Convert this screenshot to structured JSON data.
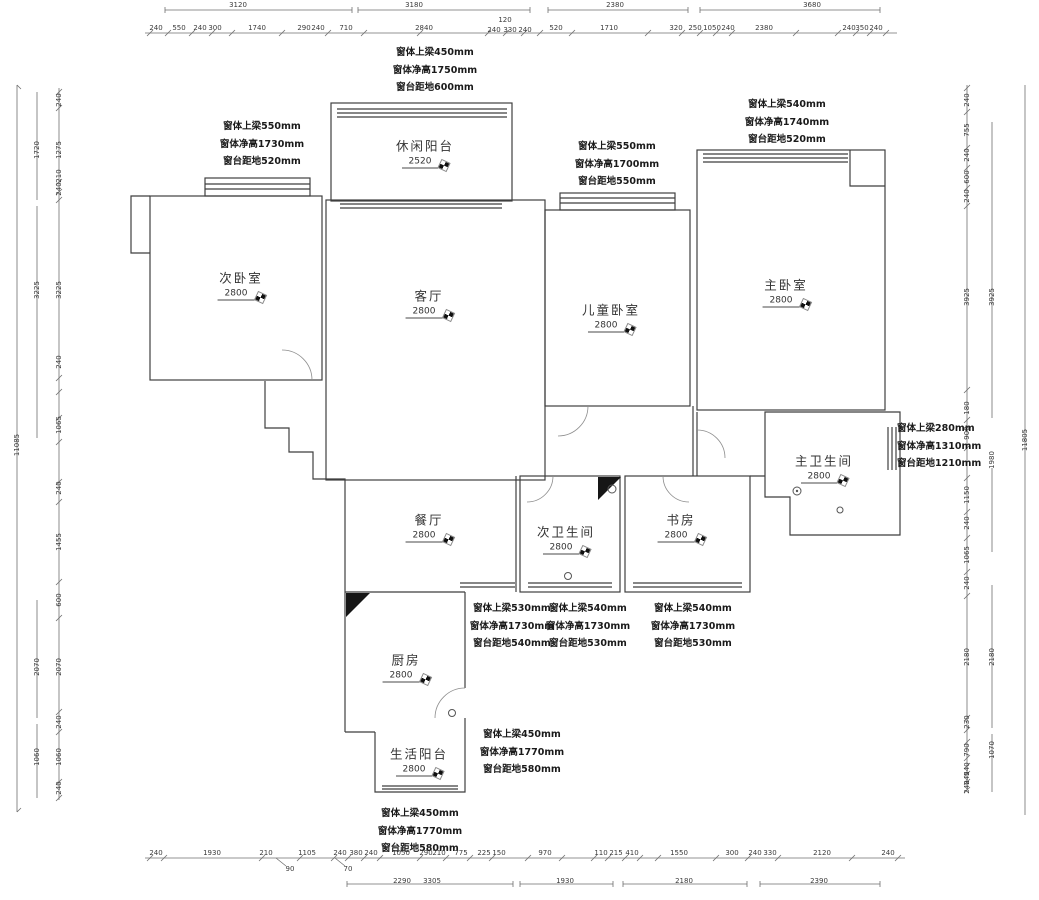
{
  "drawing": {
    "type": "residential floor plan with dimensions",
    "unit": "mm"
  },
  "rooms": [
    {
      "label": "休闲阳台",
      "value": "2520",
      "x": 425,
      "y": 152
    },
    {
      "label": "次卧室",
      "value": "2800",
      "x": 241,
      "y": 284
    },
    {
      "label": "客厅",
      "value": "2800",
      "x": 429,
      "y": 302
    },
    {
      "label": "儿童卧室",
      "value": "2800",
      "x": 611,
      "y": 316
    },
    {
      "label": "主卧室",
      "value": "2800",
      "x": 786,
      "y": 291
    },
    {
      "label": "主卫生间",
      "value": "2800",
      "x": 824,
      "y": 467
    },
    {
      "label": "餐厅",
      "value": "2800",
      "x": 429,
      "y": 526
    },
    {
      "label": "次卫生间",
      "value": "2800",
      "x": 566,
      "y": 538
    },
    {
      "label": "书房",
      "value": "2800",
      "x": 681,
      "y": 526
    },
    {
      "label": "厨房",
      "value": "2800",
      "x": 406,
      "y": 666
    },
    {
      "label": "生活阳台",
      "value": "2800",
      "x": 419,
      "y": 760
    }
  ],
  "notes": [
    {
      "x": 435,
      "y": 44,
      "lines": [
        "窗体上梁450mm",
        "窗体净高1750mm",
        "窗台距地600mm"
      ]
    },
    {
      "x": 262,
      "y": 118,
      "lines": [
        "窗体上梁550mm",
        "窗体净高1730mm",
        "窗台距地520mm"
      ]
    },
    {
      "x": 787,
      "y": 96,
      "lines": [
        "窗体上梁540mm",
        "窗体净高1740mm",
        "窗台距地520mm"
      ]
    },
    {
      "x": 617,
      "y": 138,
      "lines": [
        "窗体上梁550mm",
        "窗体净高1700mm",
        "窗台距地550mm"
      ]
    },
    {
      "x": 897,
      "y": 420,
      "align": "left",
      "lines": [
        "窗体上梁280mm",
        "窗体净高1310mm",
        "窗台距地1210mm"
      ]
    },
    {
      "x": 512,
      "y": 600,
      "lines": [
        "窗体上梁530mm",
        "窗体净高1730mm",
        "窗台距地540mm"
      ]
    },
    {
      "x": 588,
      "y": 600,
      "lines": [
        "窗体上梁540mm",
        "窗体净高1730mm",
        "窗台距地530mm"
      ]
    },
    {
      "x": 693,
      "y": 600,
      "lines": [
        "窗体上梁540mm",
        "窗体净高1730mm",
        "窗台距地530mm"
      ]
    },
    {
      "x": 522,
      "y": 726,
      "lines": [
        "窗体上梁450mm",
        "窗体净高1770mm",
        "窗台距地580mm"
      ]
    },
    {
      "x": 420,
      "y": 805,
      "lines": [
        "窗体上梁450mm",
        "窗体净高1770mm",
        "窗台距地580mm"
      ]
    }
  ],
  "dims": [
    {
      "t": "3120",
      "x": 238,
      "y": 5
    },
    {
      "t": "3180",
      "x": 414,
      "y": 5
    },
    {
      "t": "2380",
      "x": 615,
      "y": 5
    },
    {
      "t": "3680",
      "x": 812,
      "y": 5
    },
    {
      "t": "240",
      "x": 156,
      "y": 28
    },
    {
      "t": "550",
      "x": 179,
      "y": 28
    },
    {
      "t": "240",
      "x": 200,
      "y": 28
    },
    {
      "t": "300",
      "x": 215,
      "y": 28
    },
    {
      "t": "1740",
      "x": 257,
      "y": 28
    },
    {
      "t": "290",
      "x": 304,
      "y": 28
    },
    {
      "t": "240",
      "x": 318,
      "y": 28
    },
    {
      "t": "710",
      "x": 346,
      "y": 28
    },
    {
      "t": "2840",
      "x": 424,
      "y": 28
    },
    {
      "t": "120",
      "x": 505,
      "y": 20
    },
    {
      "t": "240",
      "x": 494,
      "y": 30
    },
    {
      "t": "330",
      "x": 510,
      "y": 30
    },
    {
      "t": "240",
      "x": 525,
      "y": 30
    },
    {
      "t": "520",
      "x": 556,
      "y": 28
    },
    {
      "t": "1710",
      "x": 609,
      "y": 28
    },
    {
      "t": "320",
      "x": 676,
      "y": 28
    },
    {
      "t": "250",
      "x": 695,
      "y": 28
    },
    {
      "t": "1050",
      "x": 712,
      "y": 28
    },
    {
      "t": "240",
      "x": 728,
      "y": 28
    },
    {
      "t": "2380",
      "x": 764,
      "y": 28
    },
    {
      "t": "240",
      "x": 849,
      "y": 28
    },
    {
      "t": "350",
      "x": 862,
      "y": 28
    },
    {
      "t": "240",
      "x": 876,
      "y": 28
    },
    {
      "t": "240",
      "x": 156,
      "y": 853
    },
    {
      "t": "1930",
      "x": 212,
      "y": 853
    },
    {
      "t": "210",
      "x": 266,
      "y": 853
    },
    {
      "t": "1105",
      "x": 307,
      "y": 853
    },
    {
      "t": "240",
      "x": 340,
      "y": 853
    },
    {
      "t": "380",
      "x": 356,
      "y": 853
    },
    {
      "t": "240",
      "x": 371,
      "y": 853
    },
    {
      "t": "1050",
      "x": 401,
      "y": 853
    },
    {
      "t": "290",
      "x": 426,
      "y": 853
    },
    {
      "t": "210",
      "x": 439,
      "y": 853
    },
    {
      "t": "775",
      "x": 461,
      "y": 853
    },
    {
      "t": "225",
      "x": 484,
      "y": 853
    },
    {
      "t": "150",
      "x": 499,
      "y": 853
    },
    {
      "t": "970",
      "x": 545,
      "y": 853
    },
    {
      "t": "110",
      "x": 601,
      "y": 853
    },
    {
      "t": "215",
      "x": 616,
      "y": 853
    },
    {
      "t": "410",
      "x": 632,
      "y": 853
    },
    {
      "t": "1550",
      "x": 679,
      "y": 853
    },
    {
      "t": "300",
      "x": 732,
      "y": 853
    },
    {
      "t": "240",
      "x": 755,
      "y": 853
    },
    {
      "t": "330",
      "x": 770,
      "y": 853
    },
    {
      "t": "2120",
      "x": 822,
      "y": 853
    },
    {
      "t": "240",
      "x": 888,
      "y": 853
    },
    {
      "t": "90",
      "x": 290,
      "y": 869
    },
    {
      "t": "70",
      "x": 348,
      "y": 869
    },
    {
      "t": "2290",
      "x": 402,
      "y": 881
    },
    {
      "t": "3305",
      "x": 432,
      "y": 881
    },
    {
      "t": "1930",
      "x": 565,
      "y": 881
    },
    {
      "t": "2180",
      "x": 684,
      "y": 881
    },
    {
      "t": "2390",
      "x": 819,
      "y": 881
    },
    {
      "t": "240",
      "x": 59,
      "y": 100,
      "r": 1
    },
    {
      "t": "1275",
      "x": 59,
      "y": 150,
      "r": 1
    },
    {
      "t": "210",
      "x": 59,
      "y": 176,
      "r": 1
    },
    {
      "t": "240",
      "x": 59,
      "y": 189,
      "r": 1
    },
    {
      "t": "3225",
      "x": 59,
      "y": 290,
      "r": 1
    },
    {
      "t": "240",
      "x": 59,
      "y": 362,
      "r": 1
    },
    {
      "t": "1065",
      "x": 59,
      "y": 425,
      "r": 1
    },
    {
      "t": "240",
      "x": 59,
      "y": 488,
      "r": 1
    },
    {
      "t": "1455",
      "x": 59,
      "y": 542,
      "r": 1
    },
    {
      "t": "600",
      "x": 59,
      "y": 600,
      "r": 1
    },
    {
      "t": "2070",
      "x": 59,
      "y": 667,
      "r": 1
    },
    {
      "t": "240",
      "x": 59,
      "y": 722,
      "r": 1
    },
    {
      "t": "1060",
      "x": 59,
      "y": 757,
      "r": 1
    },
    {
      "t": "240",
      "x": 59,
      "y": 788,
      "r": 1
    },
    {
      "t": "1720",
      "x": 37,
      "y": 150,
      "r": 1
    },
    {
      "t": "3225",
      "x": 37,
      "y": 290,
      "r": 1
    },
    {
      "t": "2070",
      "x": 37,
      "y": 667,
      "r": 1
    },
    {
      "t": "1060",
      "x": 37,
      "y": 757,
      "r": 1
    },
    {
      "t": "11085",
      "x": 17,
      "y": 445,
      "r": 1
    },
    {
      "t": "240",
      "x": 967,
      "y": 100,
      "r": 1
    },
    {
      "t": "755",
      "x": 967,
      "y": 130,
      "r": 1
    },
    {
      "t": "240",
      "x": 967,
      "y": 155,
      "r": 1
    },
    {
      "t": "600",
      "x": 967,
      "y": 177,
      "r": 1
    },
    {
      "t": "240",
      "x": 967,
      "y": 196,
      "r": 1
    },
    {
      "t": "3925",
      "x": 967,
      "y": 297,
      "r": 1
    },
    {
      "t": "180",
      "x": 967,
      "y": 408,
      "r": 1
    },
    {
      "t": "900",
      "x": 967,
      "y": 433,
      "r": 1
    },
    {
      "t": "1150",
      "x": 967,
      "y": 495,
      "r": 1
    },
    {
      "t": "240",
      "x": 967,
      "y": 523,
      "r": 1
    },
    {
      "t": "1065",
      "x": 967,
      "y": 555,
      "r": 1
    },
    {
      "t": "240",
      "x": 967,
      "y": 583,
      "r": 1
    },
    {
      "t": "2180",
      "x": 967,
      "y": 657,
      "r": 1
    },
    {
      "t": "230",
      "x": 967,
      "y": 722,
      "r": 1
    },
    {
      "t": "790",
      "x": 967,
      "y": 750,
      "r": 1
    },
    {
      "t": "240",
      "x": 967,
      "y": 769,
      "r": 1
    },
    {
      "t": "245",
      "x": 967,
      "y": 778,
      "r": 1
    },
    {
      "t": "240",
      "x": 967,
      "y": 787,
      "r": 1
    },
    {
      "t": "3925",
      "x": 992,
      "y": 297,
      "r": 1
    },
    {
      "t": "1980",
      "x": 992,
      "y": 460,
      "r": 1
    },
    {
      "t": "2180",
      "x": 992,
      "y": 657,
      "r": 1
    },
    {
      "t": "1070",
      "x": 992,
      "y": 750,
      "r": 1
    },
    {
      "t": "11805",
      "x": 1025,
      "y": 440,
      "r": 1
    }
  ]
}
